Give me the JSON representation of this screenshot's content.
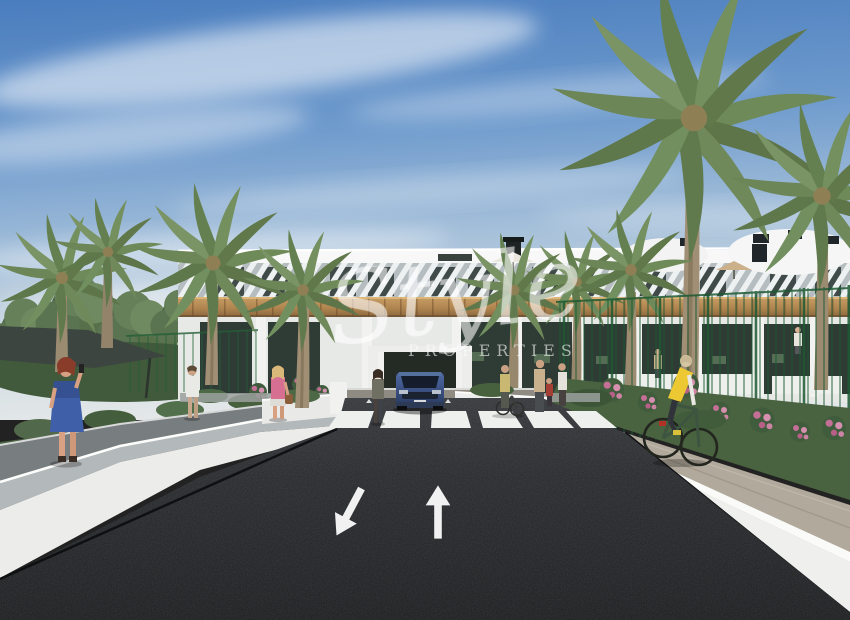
{
  "watermark": {
    "script_text": "Style",
    "caption_text": "PROPERTIES"
  },
  "scene": {
    "description": "3D architectural render: modern white two-storey apartment complex with wood accents and louvred facades, palm trees and gardens, dark asphalt road with crosswalk and two lane arrows, pedestrians on the left walkway, a cyclist in a yellow vest on the right path, and a blue car at the entrance drive",
    "road_markings": {
      "left_arrow_direction": "down-left",
      "right_arrow_direction": "up",
      "crosswalk_stripe_count": 6
    },
    "colors": {
      "sky_top": "#4a7dbe",
      "sky_horizon": "#dfe5e8",
      "building_white": "#f2f3f2",
      "wood_accent": "#b5895a",
      "window_dark": "#31403a",
      "palm_green": "#6d8557",
      "fence_green": "#1d5a33",
      "road_asphalt": "#232527",
      "road_marking_white": "#f0f1f0",
      "cyclist_vest_yellow": "#ecc832",
      "car_blue": "#3a5385",
      "dress_blue": "#3f5fa8",
      "top_pink": "#d76f93"
    }
  }
}
